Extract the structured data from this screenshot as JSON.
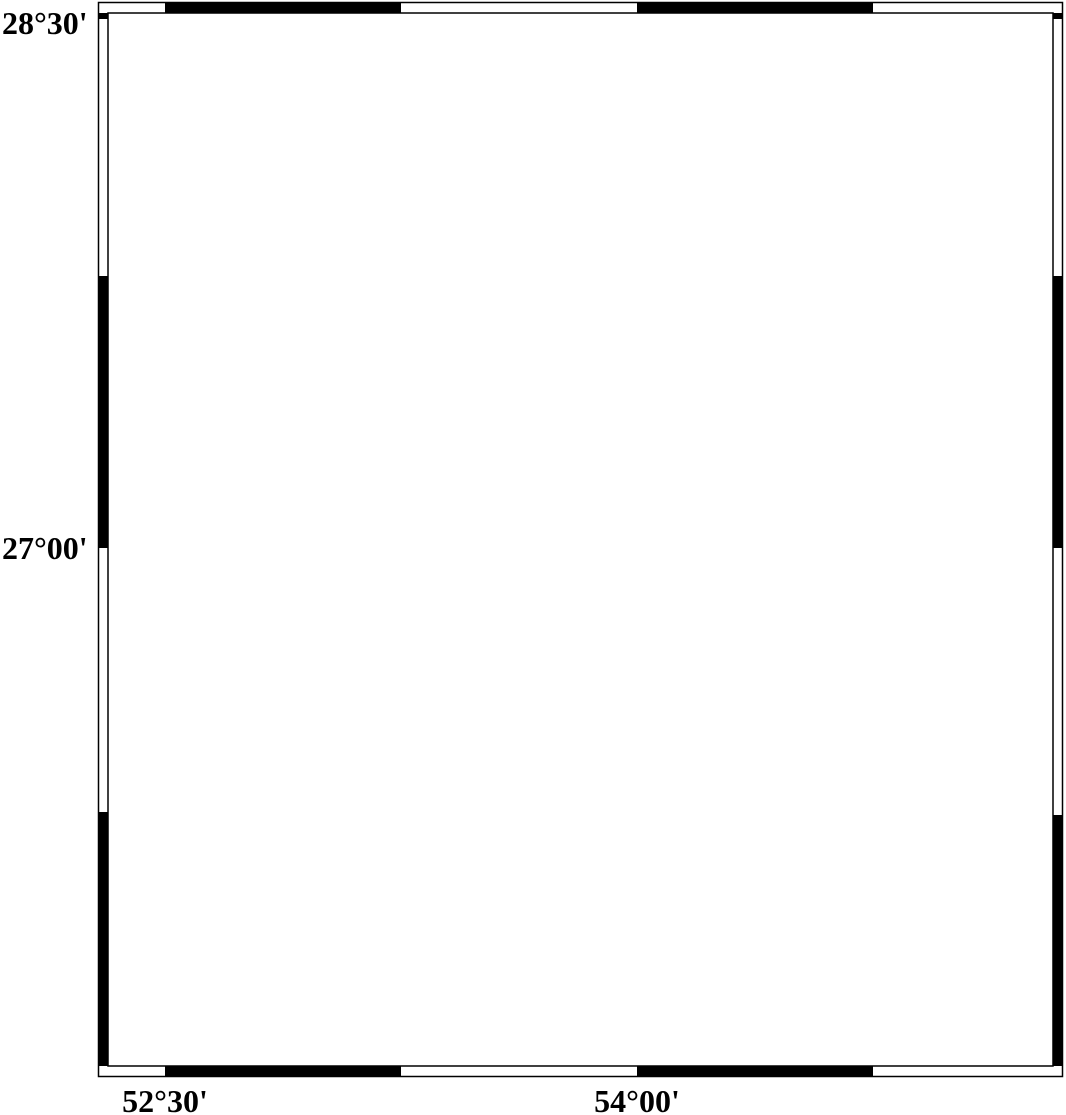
{
  "map": {
    "type": "seismicity-map",
    "gridlines_y": [
      548,
      899
    ],
    "axis": {
      "left_labels": [
        {
          "text": "28°30'"
        },
        {
          "text": "27°00'"
        }
      ],
      "bottom_labels": [
        {
          "text": "52°30'"
        },
        {
          "text": "54°00'"
        }
      ]
    },
    "scale_bar": {
      "label": "60 km"
    }
  },
  "legend": {
    "title": "Magnitude",
    "entries": [
      {
        "label": "3",
        "cy": 860,
        "r": 11
      },
      {
        "label": "4",
        "cy": 898,
        "r": 15
      },
      {
        "label": "5",
        "cy": 937,
        "r": 18.5
      },
      {
        "label": "6",
        "cy": 976,
        "r": 22.5
      },
      {
        "label": "7",
        "cy": 1014,
        "r": 25.5
      }
    ],
    "circle_cx": 200,
    "number_x": 258
  },
  "markers": {
    "station": {
      "x": 319,
      "y": 89
    },
    "earthquakes": [
      {
        "cx": 276,
        "cy": 231,
        "r": 13
      },
      {
        "cx": 583,
        "cy": 543,
        "r": 13.5
      }
    ]
  },
  "colors": {
    "sea": "#58b0f7",
    "coastline": "#181868",
    "earthquake_fill": "#fb0000",
    "marker_outline": "#000000",
    "station_outer": "#b9b9b9",
    "station_inner": "#000000",
    "road": "#3a3a3a",
    "gridline": "rgba(255,255,255,0.55)"
  }
}
